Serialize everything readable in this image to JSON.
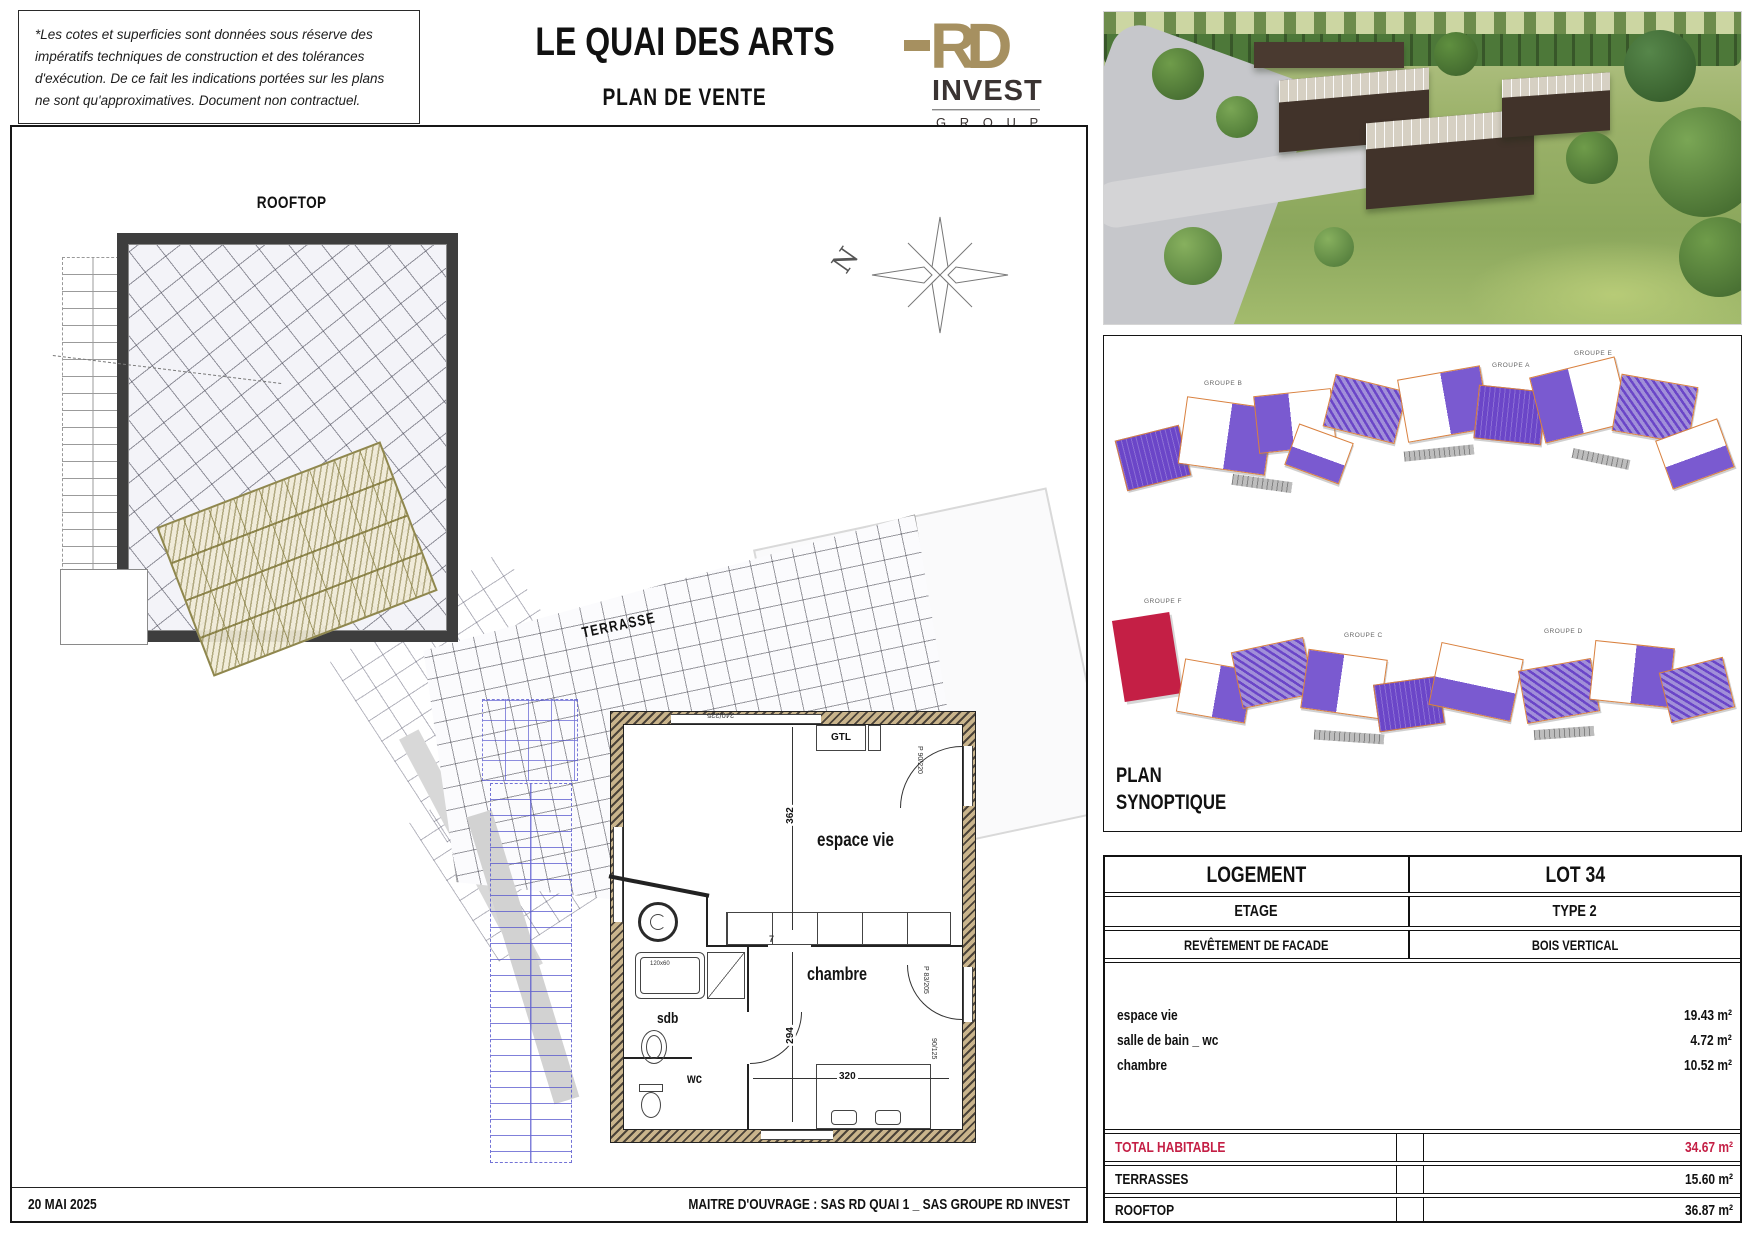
{
  "disclaimer": "*Les cotes et superficies sont données sous réserve des impératifs techniques de construction et des tolérances d'exécution. De ce fait les indications portées sur les plans ne sont qu'approximatives. Document non contractuel.",
  "header": {
    "title": "LE QUAI DES ARTS",
    "subtitle": "PLAN DE VENTE"
  },
  "logo": {
    "rd": "RD",
    "invest": "INVEST",
    "group": "G R O U P"
  },
  "plan": {
    "rooftop_label": "ROOFTOP",
    "terrace_label": "TERRASSE",
    "north": "N",
    "labels": {
      "espace_vie": "espace vie",
      "chambre": "chambre",
      "sdb": "sdb",
      "wc": "wc",
      "gtl": "GTL"
    },
    "dims": {
      "h1": "362",
      "h2": "294",
      "w1": "320",
      "top": "240/225",
      "door_right": "P 90/220",
      "door_chambre": "P 83/205",
      "win_bottom": "90/125",
      "bath": "120x60",
      "seven": "7"
    }
  },
  "synoptic": {
    "title_line1": "PLAN",
    "title_line2": "SYNOPTIQUE",
    "groups": [
      "GROUPE A",
      "GROUPE B",
      "GROUPE E",
      "GROUPE F",
      "GROUPE C",
      "GROUPE D"
    ]
  },
  "table": {
    "rows": [
      {
        "label": "LOGEMENT",
        "value": "LOT 34"
      },
      {
        "label": "ETAGE",
        "value": "TYPE 2"
      },
      {
        "label": "REVÊTEMENT DE FACADE",
        "value": "BOIS VERTICAL"
      }
    ],
    "rooms": [
      {
        "label": "espace vie",
        "value": "19.43 m²"
      },
      {
        "label": "salle de bain _ wc",
        "value": "4.72 m²"
      },
      {
        "label": "chambre",
        "value": "10.52 m²"
      }
    ],
    "totals": [
      {
        "label": "TOTAL HABITABLE",
        "value": "34.67 m²"
      },
      {
        "label": "TERRASSES",
        "value": "15.60 m²"
      },
      {
        "label": "ROOFTOP",
        "value": "36.87 m²"
      }
    ]
  },
  "footer": {
    "date": "20 MAI 2025",
    "owner": "MAITRE D'OUVRAGE : SAS RD QUAI 1 _ SAS GROUPE RD INVEST"
  },
  "colors": {
    "accent_red": "#c41f45",
    "logo_gold": "#a69060",
    "synoptic_purple": "#6b46c8",
    "synoptic_orange": "#d9813f"
  }
}
